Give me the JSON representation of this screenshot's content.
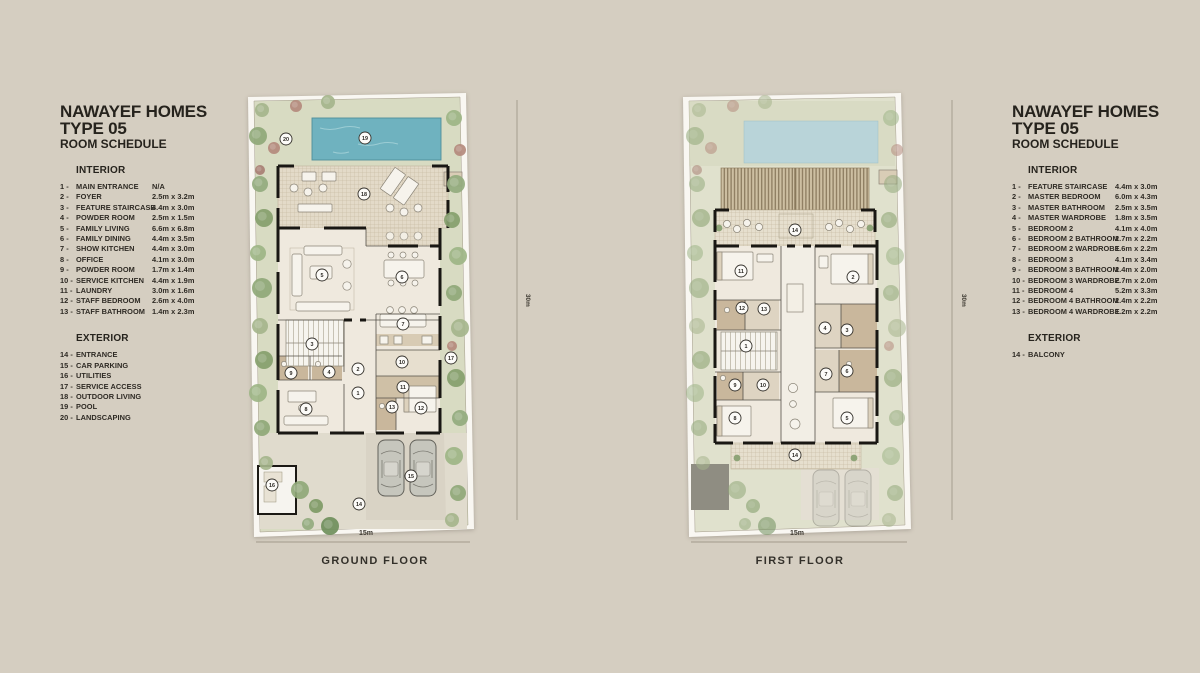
{
  "page": {
    "background": "#d5cec1"
  },
  "left_schedule": {
    "title_line1": "NAWAYEF HOMES",
    "title_line2": "TYPE 05",
    "subtitle": "ROOM SCHEDULE",
    "interior_heading": "INTERIOR",
    "interior": [
      {
        "num": "1",
        "label": "MAIN ENTRANCE",
        "size": "N/A"
      },
      {
        "num": "2",
        "label": "FOYER",
        "size": "2.5m x 3.2m"
      },
      {
        "num": "3",
        "label": "FEATURE STAIRCASE",
        "size": "4.4m x 3.0m"
      },
      {
        "num": "4",
        "label": "POWDER ROOM",
        "size": "2.5m x 1.5m"
      },
      {
        "num": "5",
        "label": "FAMILY LIVING",
        "size": "6.6m x 6.8m"
      },
      {
        "num": "6",
        "label": "FAMILY DINING",
        "size": "4.4m x 3.5m"
      },
      {
        "num": "7",
        "label": "SHOW KITCHEN",
        "size": "4.4m x 3.0m"
      },
      {
        "num": "8",
        "label": "OFFICE",
        "size": "4.1m x 3.0m"
      },
      {
        "num": "9",
        "label": "POWDER ROOM",
        "size": "1.7m x 1.4m"
      },
      {
        "num": "10",
        "label": "SERVICE KITCHEN",
        "size": "4.4m x 1.9m"
      },
      {
        "num": "11",
        "label": "LAUNDRY",
        "size": "3.0m x 1.6m"
      },
      {
        "num": "12",
        "label": "STAFF BEDROOM",
        "size": "2.6m x 4.0m"
      },
      {
        "num": "13",
        "label": "STAFF BATHROOM",
        "size": "1.4m x 2.3m"
      }
    ],
    "exterior_heading": "EXTERIOR",
    "exterior": [
      {
        "num": "14",
        "label": "ENTRANCE"
      },
      {
        "num": "15",
        "label": "CAR PARKING"
      },
      {
        "num": "16",
        "label": "UTILITIES"
      },
      {
        "num": "17",
        "label": "SERVICE ACCESS"
      },
      {
        "num": "18",
        "label": "OUTDOOR LIVING"
      },
      {
        "num": "19",
        "label": "POOL"
      },
      {
        "num": "20",
        "label": "LANDSCAPING"
      }
    ]
  },
  "right_schedule": {
    "title_line1": "NAWAYEF HOMES",
    "title_line2": "TYPE 05",
    "subtitle": "ROOM SCHEDULE",
    "interior_heading": "INTERIOR",
    "interior": [
      {
        "num": "1",
        "label": "FEATURE STAIRCASE",
        "size": "4.4m x 3.0m"
      },
      {
        "num": "2",
        "label": "MASTER BEDROOM",
        "size": "6.0m x 4.3m"
      },
      {
        "num": "3",
        "label": "MASTER BATHROOM",
        "size": "2.5m x 3.5m"
      },
      {
        "num": "4",
        "label": "MASTER WARDROBE",
        "size": "1.8m x 3.5m"
      },
      {
        "num": "5",
        "label": "BEDROOM 2",
        "size": "4.1m x 4.0m"
      },
      {
        "num": "6",
        "label": "BEDROOM 2 BATHROOM",
        "size": "2.7m x 2.2m"
      },
      {
        "num": "7",
        "label": "BEDROOM 2 WARDROBE",
        "size": "1.6m x 2.2m"
      },
      {
        "num": "8",
        "label": "BEDROOM 3",
        "size": "4.1m x 3.4m"
      },
      {
        "num": "9",
        "label": "BEDROOM 3 BATHROOM",
        "size": "2.4m x 2.0m"
      },
      {
        "num": "10",
        "label": "BEDROOM 3 WARDROBE",
        "size": "2.7m x 2.0m"
      },
      {
        "num": "11",
        "label": "BEDROOM 4",
        "size": "5.2m x 3.3m"
      },
      {
        "num": "12",
        "label": "BEDROOM 4 BATHROOM",
        "size": "2.4m x 2.2m"
      },
      {
        "num": "13",
        "label": "BEDROOM 4 WARDROBE",
        "size": "1.2m x 2.2m"
      }
    ],
    "exterior_heading": "EXTERIOR",
    "exterior": [
      {
        "num": "14",
        "label": "BALCONY"
      }
    ]
  },
  "ground_floor": {
    "caption": "GROUND FLOOR",
    "width_label": "15m",
    "height_label": "30m",
    "markers": [
      {
        "n": "20",
        "x": 48,
        "y": 51
      },
      {
        "n": "19",
        "x": 127,
        "y": 50
      },
      {
        "n": "18",
        "x": 126,
        "y": 106
      },
      {
        "n": "5",
        "x": 84,
        "y": 187
      },
      {
        "n": "6",
        "x": 164,
        "y": 189
      },
      {
        "n": "7",
        "x": 165,
        "y": 236
      },
      {
        "n": "3",
        "x": 74,
        "y": 256
      },
      {
        "n": "9",
        "x": 53,
        "y": 285
      },
      {
        "n": "4",
        "x": 91,
        "y": 284
      },
      {
        "n": "2",
        "x": 120,
        "y": 281
      },
      {
        "n": "1",
        "x": 120,
        "y": 305
      },
      {
        "n": "10",
        "x": 164,
        "y": 274
      },
      {
        "n": "11",
        "x": 165,
        "y": 299
      },
      {
        "n": "13",
        "x": 154,
        "y": 319
      },
      {
        "n": "12",
        "x": 183,
        "y": 320
      },
      {
        "n": "8",
        "x": 68,
        "y": 321
      },
      {
        "n": "17",
        "x": 213,
        "y": 270
      },
      {
        "n": "16",
        "x": 34,
        "y": 397
      },
      {
        "n": "15",
        "x": 173,
        "y": 388
      },
      {
        "n": "14",
        "x": 121,
        "y": 416
      }
    ]
  },
  "first_floor": {
    "caption": "FIRST FLOOR",
    "width_label": "15m",
    "height_label": "30m",
    "markers": [
      {
        "n": "14",
        "x": 120,
        "y": 142
      },
      {
        "n": "11",
        "x": 66,
        "y": 183
      },
      {
        "n": "2",
        "x": 178,
        "y": 189
      },
      {
        "n": "12",
        "x": 67,
        "y": 220
      },
      {
        "n": "13",
        "x": 89,
        "y": 221
      },
      {
        "n": "4",
        "x": 150,
        "y": 240
      },
      {
        "n": "3",
        "x": 172,
        "y": 242
      },
      {
        "n": "1",
        "x": 71,
        "y": 258
      },
      {
        "n": "9",
        "x": 60,
        "y": 297
      },
      {
        "n": "10",
        "x": 88,
        "y": 297
      },
      {
        "n": "7",
        "x": 151,
        "y": 286
      },
      {
        "n": "6",
        "x": 172,
        "y": 283
      },
      {
        "n": "8",
        "x": 60,
        "y": 330
      },
      {
        "n": "5",
        "x": 172,
        "y": 330
      },
      {
        "n": "14",
        "x": 120,
        "y": 367
      }
    ]
  },
  "colors": {
    "background": "#d5cec1",
    "sheet": "#f9f7f2",
    "lawn": "#d8dbc2",
    "pool": "#6fb2bf",
    "pool_faded": "#b9d4d9",
    "deck": "#e3dac8",
    "room": "#efe9de",
    "wet_room": "#c9b79c",
    "wall": "#191713",
    "pergola": "#cdbfa2"
  }
}
